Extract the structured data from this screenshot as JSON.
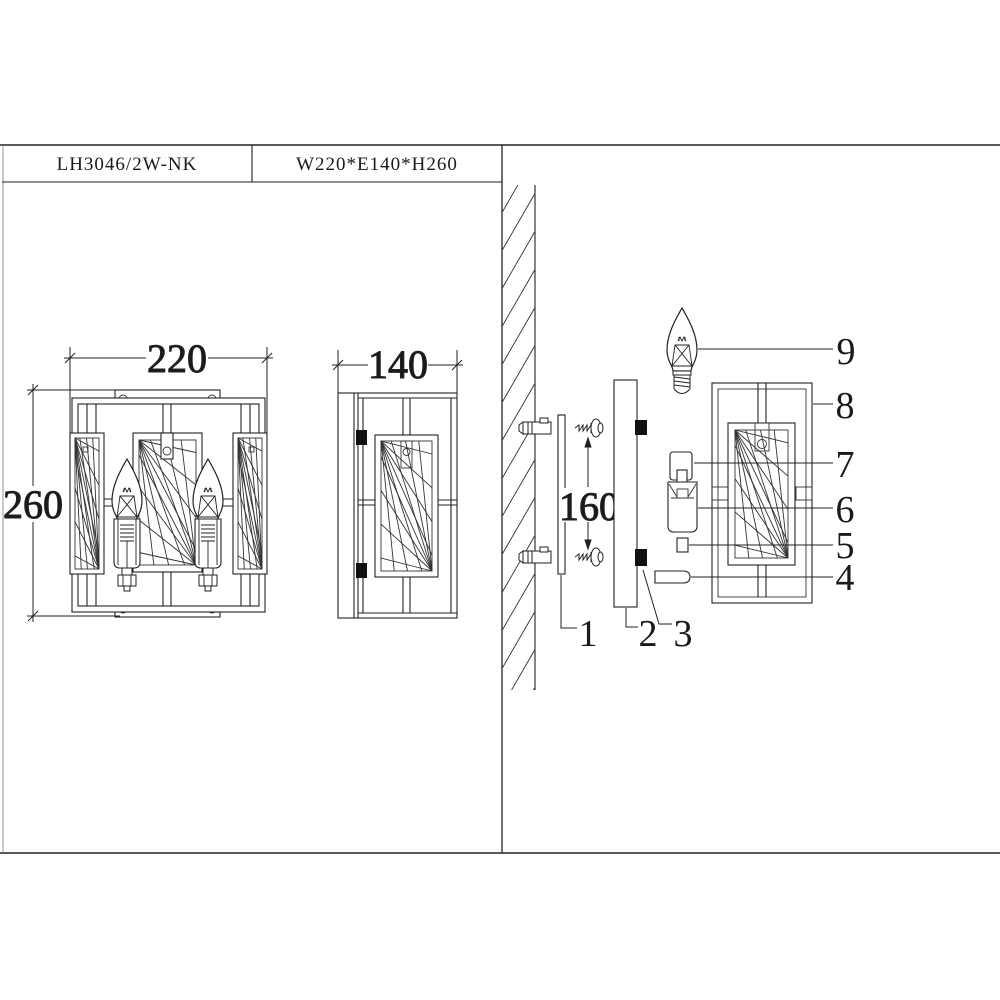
{
  "title_block": {
    "model": "LH3046/2W-NK",
    "size_spec": "W220*E140*H260"
  },
  "front_view": {
    "width_dim": "220",
    "height_dim": "260"
  },
  "side_view": {
    "depth_dim": "140"
  },
  "exploded_view": {
    "mount_spacing_dim": "160",
    "parts": [
      "1",
      "2",
      "3",
      "4",
      "5",
      "6",
      "7",
      "8",
      "9"
    ]
  },
  "colors": {
    "line": "#222222",
    "background": "#ffffff",
    "clip_fill": "#111111"
  }
}
